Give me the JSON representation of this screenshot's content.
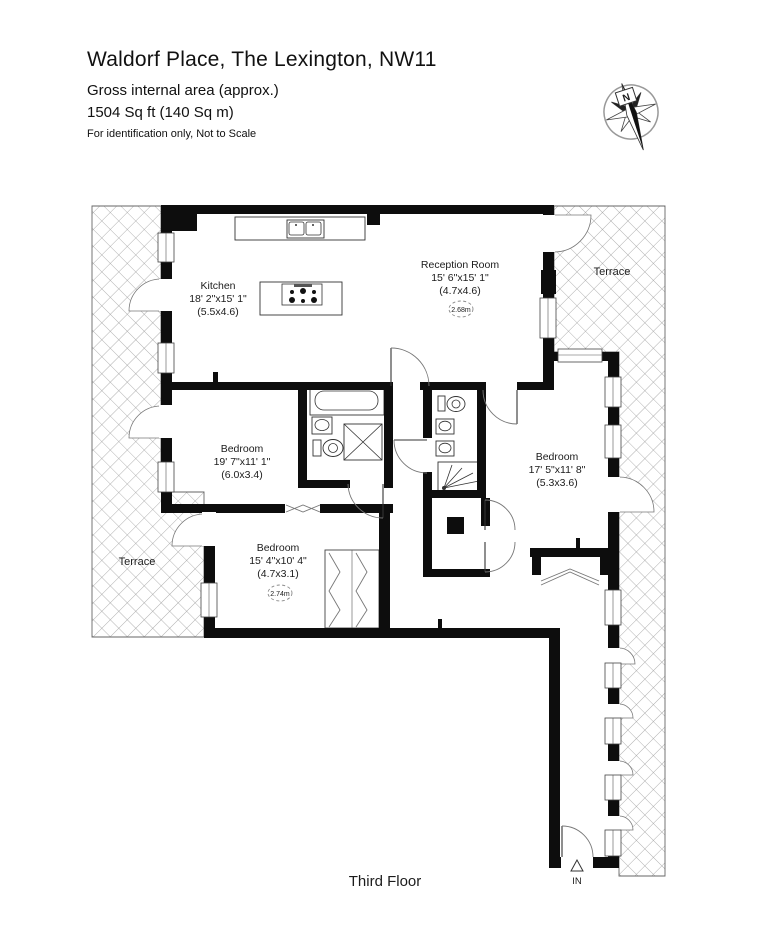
{
  "header": {
    "title": "Waldorf Place, The Lexington, NW11",
    "subtitle": "Gross internal area (approx.)",
    "area": "1504 Sq ft (140 Sq m)",
    "disclaimer": "For identification only, Not to Scale"
  },
  "plan": {
    "floor_label": "Third Floor",
    "entry_label": "IN",
    "compass_label": "N",
    "terrace_right_label": "Terrace",
    "terrace_left_label": "Terrace",
    "rooms": {
      "reception": {
        "name": "Reception Room",
        "dims": "15' 6\"x15' 1\"",
        "metric": "(4.7x4.6)",
        "ceiling_height": "2.68m"
      },
      "kitchen": {
        "name": "Kitchen",
        "dims": "18' 2\"x15' 1\"",
        "metric": "(5.5x4.6)"
      },
      "bedroom_left": {
        "name": "Bedroom",
        "dims": "19' 7\"x11' 1\"",
        "metric": "(6.0x3.4)"
      },
      "bedroom_bottom": {
        "name": "Bedroom",
        "dims": "15' 4\"x10' 4\"",
        "metric": "(4.7x3.1)",
        "ceiling_height": "2.74m"
      },
      "bedroom_right": {
        "name": "Bedroom",
        "dims": "17' 5\"x11' 8\"",
        "metric": "(5.3x3.6)"
      }
    },
    "colors": {
      "wall": "#0d0d0d",
      "hatch_line": "#9b9b9b"
    }
  }
}
